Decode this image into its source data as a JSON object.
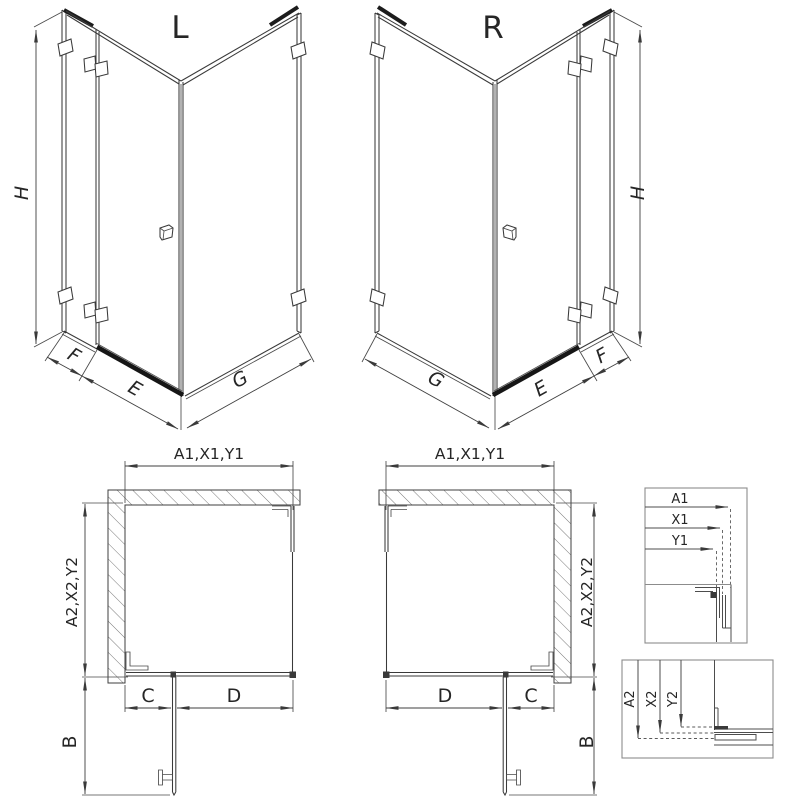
{
  "drawing": {
    "iso_left": {
      "variant": "L",
      "height": "H",
      "fixed_width": "F",
      "door_width": "E",
      "side_width": "G"
    },
    "iso_right": {
      "variant": "R",
      "height": "H",
      "fixed_width": "F",
      "door_width": "E",
      "side_width": "G"
    },
    "plan_left": {
      "width": "A1,X1,Y1",
      "depth": "A2,X2,Y2",
      "fixed": "C",
      "door": "D",
      "swing": "B"
    },
    "plan_right": {
      "width": "A1,X1,Y1",
      "depth": "A2,X2,Y2",
      "fixed": "C",
      "door": "D",
      "swing": "B"
    },
    "detail_width": {
      "rows": [
        "A1",
        "X1",
        "Y1"
      ]
    },
    "detail_depth": {
      "rows": [
        "A2",
        "X2",
        "Y2"
      ]
    },
    "colors": {
      "line": "#3a3a3a",
      "thick": "#1c1c1c",
      "frame": "#8c8c8c",
      "background": "#ffffff"
    }
  }
}
